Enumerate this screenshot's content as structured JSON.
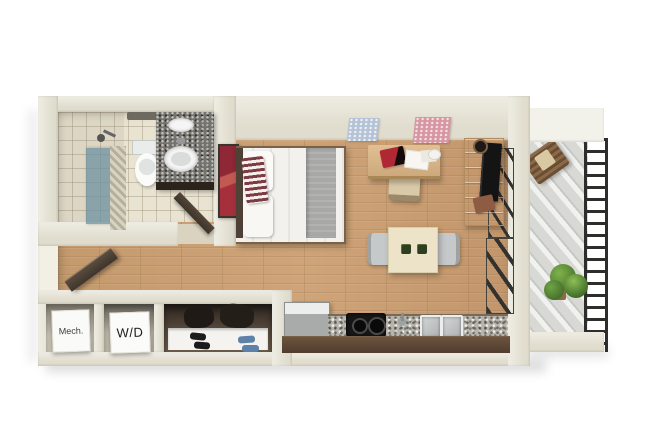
{
  "image": {
    "kind": "3d-rendered-floor-plan",
    "subject": "studio-apartment-top-view"
  },
  "labels": {
    "mech_closet": "Mech.",
    "washer_dryer": "W/D"
  },
  "semantic_areas": [
    "bathroom",
    "shower",
    "sleeping-area",
    "living-area",
    "dining-area",
    "kitchen",
    "entry",
    "mechanical-closet",
    "laundry-closet",
    "shoe-closet",
    "balcony"
  ],
  "palette": {
    "bg": "#ffffff",
    "wall": "#e0ddce",
    "wall_light": "#efede3",
    "wall_dark": "#c9c5b2",
    "wood": "#c79c70",
    "wood_dark": "#b08355",
    "tile": "#e9e3d2",
    "granite": "#b7b4ab",
    "granite_dark": "#75736d",
    "cabinet": "#5e4937",
    "bed_linen": "#f2f1ed",
    "blanket": "#a8a8a6",
    "pillow_stripe": "#7c3b45",
    "art_red": "#a62f3c",
    "art_blue": "#b5c3d7",
    "art_pink": "#d796a2",
    "desk_wood": "#dcbc8e",
    "console_wood": "#dfc497",
    "tv": "#141414",
    "table": "#ece3c8",
    "chair_gray": "#c6c9ca",
    "mat_green": "#2f3d20",
    "fridge": "#a9abab",
    "door": "#4a3e33",
    "glass_teal": "#7795a1",
    "balcony_floor": "#d8d9d4",
    "railing": "#2d2d2b",
    "plant": "#4e7c33",
    "shoe_black": "#1b1b1e",
    "shoe_blue": "#5d81a9"
  }
}
